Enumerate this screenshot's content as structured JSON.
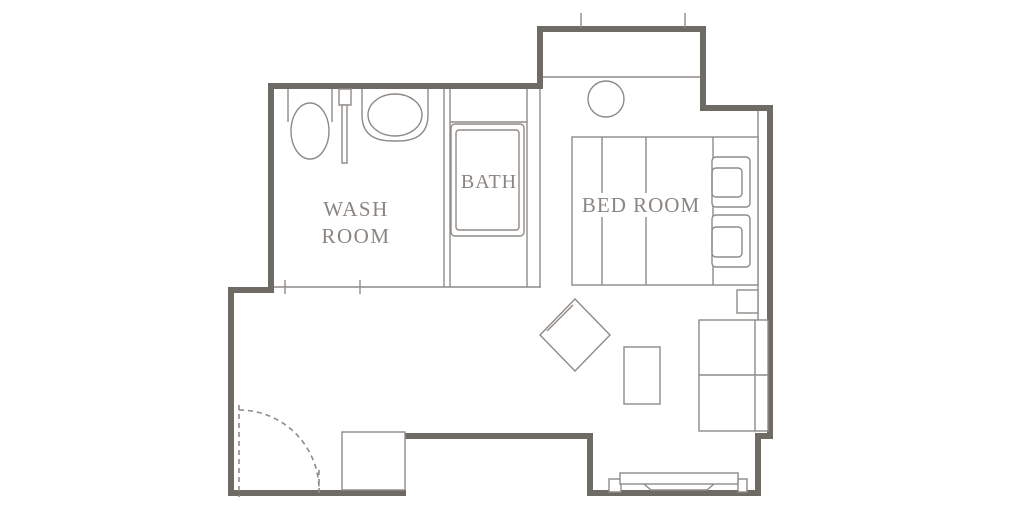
{
  "diagram": {
    "type": "floor-plan",
    "rooms": {
      "washroom": {
        "label_line1": "WASH",
        "label_line2": "ROOM"
      },
      "bath": {
        "label": "BATH"
      },
      "bedroom": {
        "label": "BED ROOM"
      }
    },
    "colors": {
      "background": "#ffffff",
      "wall": "#6e6a64",
      "line": "#8f8a85",
      "label": "#8a8580"
    }
  }
}
